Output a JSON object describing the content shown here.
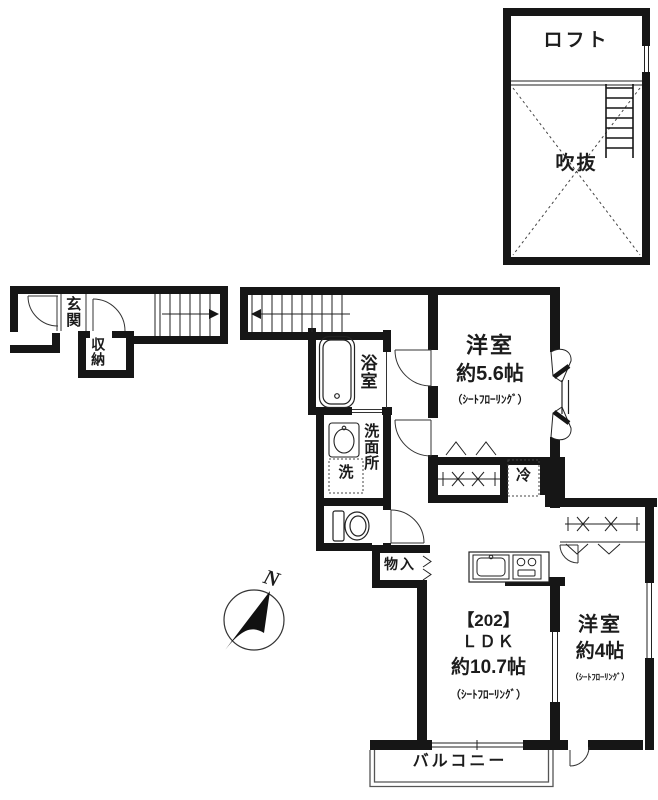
{
  "floorplan": {
    "loft_section": {
      "loft": "ロフト",
      "void": "吹抜"
    },
    "first_floor": {
      "entrance": "玄関",
      "storage": "収納"
    },
    "second_floor": {
      "bath": "浴室",
      "washroom": "洗面所",
      "washer": "洗",
      "closet": "物入",
      "fridge": "冷",
      "bedroom1": {
        "type": "洋室",
        "area": "約5.6帖",
        "flooring": "（ｼｰﾄﾌﾛｰﾘﾝｸﾞ）"
      },
      "ldk": {
        "unit_no": "【202】",
        "type": "ＬＤＫ",
        "area": "約10.7帖",
        "flooring": "（ｼｰﾄﾌﾛｰﾘﾝｸﾞ）"
      },
      "bedroom2": {
        "type": "洋室",
        "area": "約4帖",
        "flooring": "（ｼｰﾄﾌﾛｰﾘﾝｸﾞ）"
      },
      "balcony": "バルコニー"
    },
    "compass": {
      "north": "N"
    },
    "colors": {
      "line": "#161616",
      "background": "#ffffff"
    }
  }
}
